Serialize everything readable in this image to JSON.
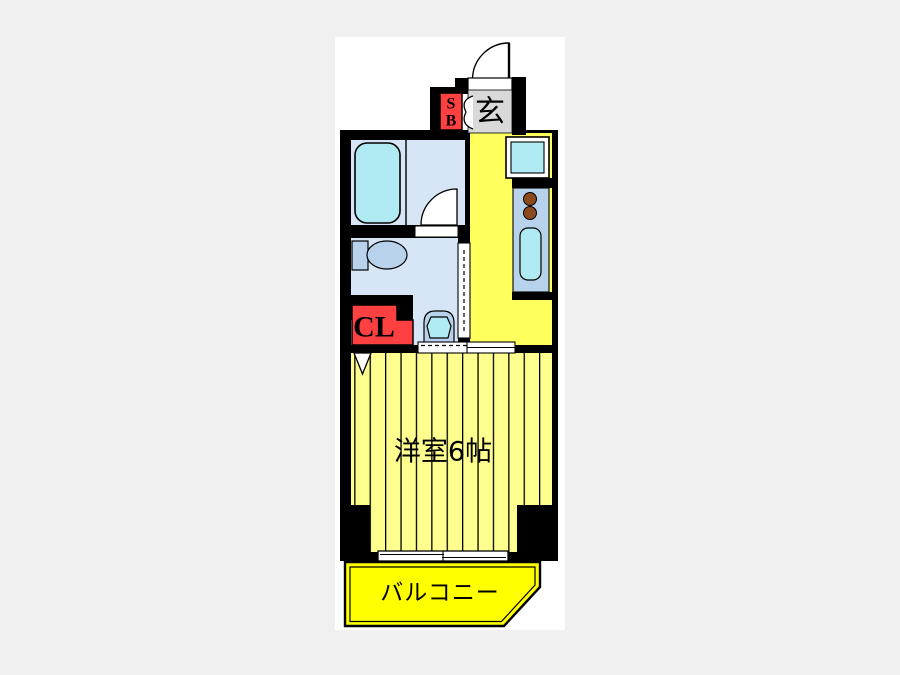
{
  "plan": {
    "type": "apartment-floor-plan",
    "labels": {
      "entrance": "玄",
      "shoe_box_line1": "S",
      "shoe_box_line2": "B",
      "closet": "CL",
      "main_room": "洋室6帖",
      "balcony": "バルコニー"
    }
  },
  "colors": {
    "background": "#f0f0f0",
    "canvas": "#ffffff",
    "wall": "#000000",
    "entrance_gray": "#d9d9d9",
    "red": "#ff4040",
    "room_light_blue": "#d7e6f6",
    "fixture_blue": "#b9d2ec",
    "fixture_cyan": "#b0eaf2",
    "kitchen_yellow": "#ffff5e",
    "room_yellow": "#ffff8f",
    "balcony_yellow": "#ffff00",
    "burner_brown": "#8a4a1d"
  }
}
